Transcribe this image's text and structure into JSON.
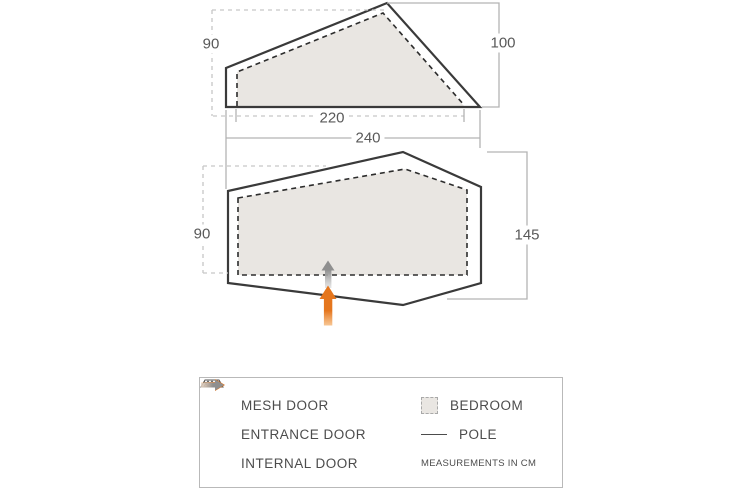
{
  "diagram": {
    "title": "tent dimensions diagram",
    "side_view": {
      "inner_height": "90",
      "outer_height": "100",
      "inner_length": "220",
      "outer_length": "240"
    },
    "floor_plan": {
      "bedroom_depth": "90",
      "outer_depth": "145",
      "markers": [
        "entrance-door-arrow",
        "internal-door-arrow"
      ]
    }
  },
  "legend": {
    "mesh_door": "MESH DOOR",
    "entrance_door": "ENTRANCE DOOR",
    "internal_door": "INTERNAL DOOR",
    "bedroom": "BEDROOM",
    "pole": "POLE",
    "note": "MEASUREMENTS IN CM"
  },
  "icons": {
    "mesh": "mesh-door-icon",
    "entrance": "entrance-arrow-icon",
    "internal": "internal-arrow-icon",
    "bedroom": "bedroom-swatch-icon",
    "pole": "pole-line-icon"
  },
  "colors": {
    "outline": "#3a3a3a",
    "inner_line": "#2d2d2d",
    "tent_fill": "#e9e6e2",
    "dim_line": "#b3b3b3",
    "dim_dash": "#c6c6c6",
    "label_text": "#595959",
    "legend_text": "#4c4c4c",
    "legend_border": "#b9b9b9",
    "entrance": "#e5761d",
    "entrance_light": "#f6bb80",
    "internal": "#8f8f8f",
    "internal_light": "#dcdcdc"
  }
}
